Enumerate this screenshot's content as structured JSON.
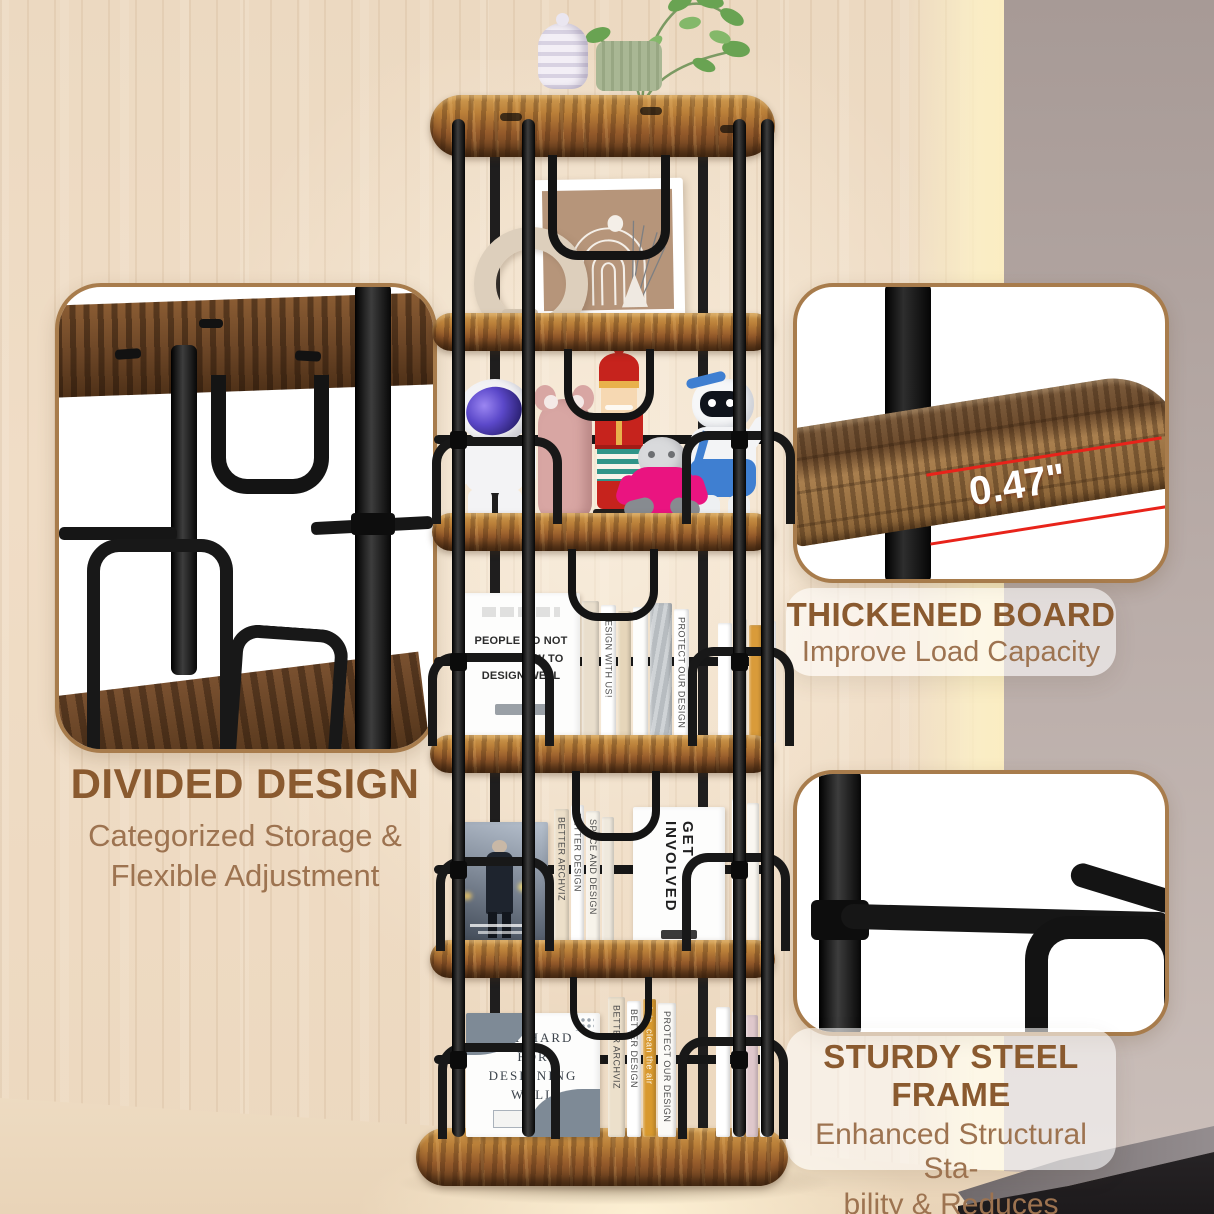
{
  "product_labels": {
    "divided": {
      "title": "DIVIDED DESIGN",
      "sub1": "Categorized Storage &",
      "sub2": "Flexible Adjustment"
    },
    "thickened": {
      "title": "THICKENED BOARD",
      "sub1": "Improve Load Capacity",
      "measurement": "0.47\""
    },
    "sturdy": {
      "title": "STURDY STEEL FRAME",
      "sub1": "Enhanced Structural Sta-",
      "sub2": "bility & Reduces Wobbling"
    }
  },
  "books": {
    "mid_face": {
      "l1": "PEOPLE DO NOT",
      "l2": "KNOW HOW TO",
      "l3": "DESIGN WELL"
    },
    "mid_spine1": "DESIGN WITH US!",
    "mid_spine2": "PROTECT OUR DESIGN",
    "lower_face": "GET INVOLVED",
    "lower_spine1": "BETTER ARCHVIZ",
    "lower_spine2": "BETTER DESIGN",
    "lower_spine3": "SPACE AND DESIGN",
    "bottom_face": {
      "l1": "TRY HARD",
      "l2": "FOR",
      "l3": "DESIGNING",
      "l4": "WELL"
    },
    "bottom_spine1": "BETTER ARCHVIZ",
    "bottom_spine2": "BETTER DESIGN",
    "bottom_spine3": "lets, clean the air",
    "bottom_spine4": "PROTECT OUR DESIGN"
  },
  "colors": {
    "title_brown": "#8a5a2f",
    "subtitle_brown": "#9d7350",
    "measure_red": "#e8231a",
    "inset_border": "#a87c4c",
    "metal_black": "#161616",
    "shelf_wood": "#a4662c",
    "wood_wall": "#eddcc5",
    "accent_wall": "#b3a6a2"
  }
}
